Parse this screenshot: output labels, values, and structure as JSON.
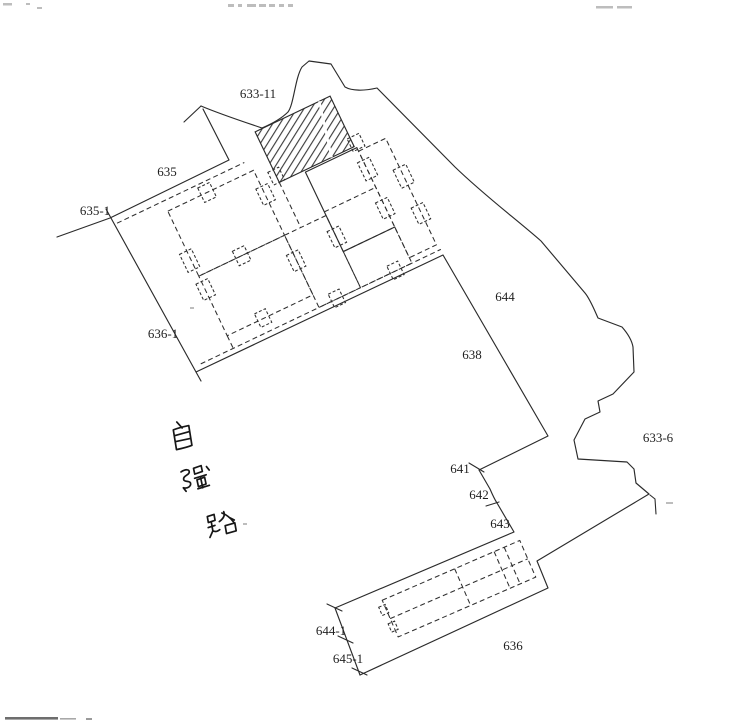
{
  "map": {
    "parcels": [
      "633-11",
      "635",
      "635-1",
      "636-1",
      "644",
      "638",
      "633-6",
      "641",
      "642",
      "643",
      "644-1",
      "645-1",
      "636"
    ],
    "road_name": "自強路",
    "road_name_chars": [
      "自",
      "強",
      "路"
    ],
    "features": {
      "hatched_parcel": "633-11 hatched area",
      "building_cluster": "dashed building footprints",
      "road_strip": "road strip with building 636"
    },
    "colors": {
      "ink": "#2b2b2b",
      "paper": "#ffffff",
      "artifact": "#bdbdbd"
    }
  }
}
